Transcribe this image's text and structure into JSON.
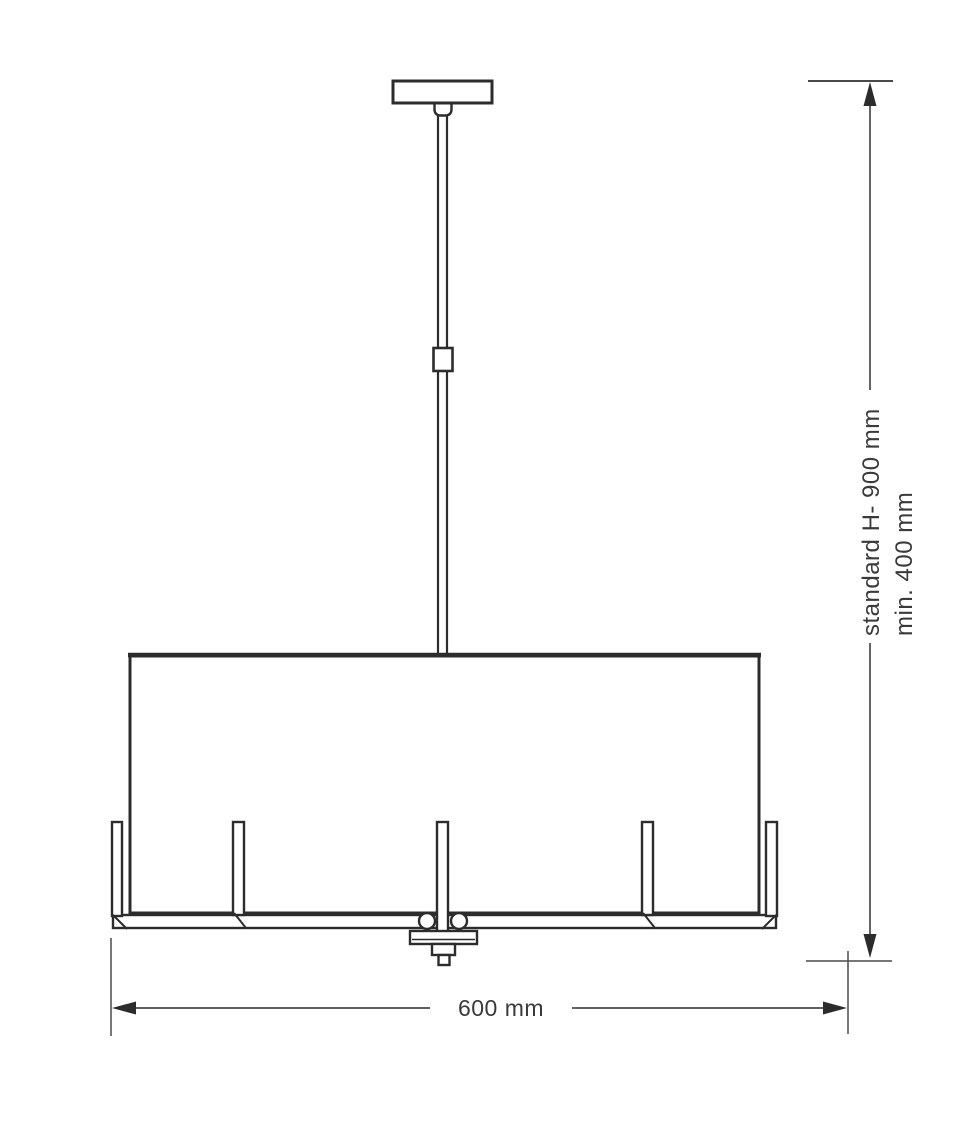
{
  "diagram": {
    "kind": "technical-dimension-drawing",
    "subject": "pendant-lamp",
    "labels": {
      "height_standard": "standard H- 900 mm",
      "height_min": "min. 400 mm",
      "width": "600 mm"
    },
    "colors": {
      "line": "#2c2c2c",
      "dimension_line": "#4a4a4a",
      "text": "#3a3a3a",
      "background": "#ffffff"
    }
  }
}
